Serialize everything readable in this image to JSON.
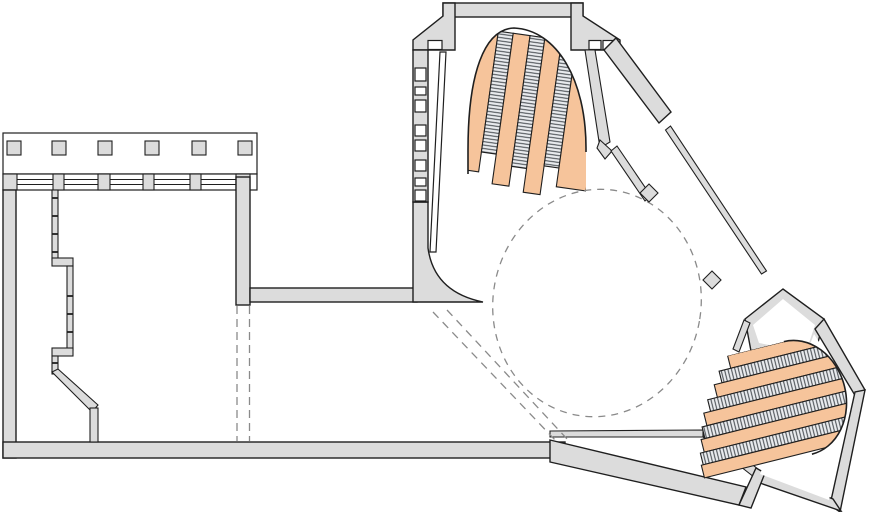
{
  "meta": {
    "title": "Architectural floor plan — concourse level with two escalator banks",
    "type": "floor-plan-drawing"
  },
  "colors": {
    "background": "#ffffff",
    "wall_fill": "#dcdcdc",
    "wall_stroke": "#1f1f1f",
    "stair_orange": "#f6c49b",
    "tread_fill": "#e9ebee",
    "tread_stroke": "#41464b",
    "dashed_line": "#8a8a8a"
  },
  "elements": {
    "left_hall": {
      "name": "left-hall",
      "roof_squares": 6,
      "window_band_pilasters": 4,
      "facade_window_rungs": 8,
      "stepped_wall_ticks": 8
    },
    "entrance_stair_hall": {
      "name": "entrance-stair-hall",
      "jog_windows": 3
    },
    "escalator_bank_top": {
      "orange_bands": 4,
      "tread_bands": 3,
      "cap": "arched-top"
    },
    "escalator_bank_bottom": {
      "orange_bands": 5,
      "tread_bands": 4,
      "cap": "rounded-right"
    },
    "concourse": {
      "dashed_oval": 1,
      "dashed_vertical_guides": 2,
      "dashed_diagonal_guides": 2,
      "diamond_columns": 2
    }
  }
}
